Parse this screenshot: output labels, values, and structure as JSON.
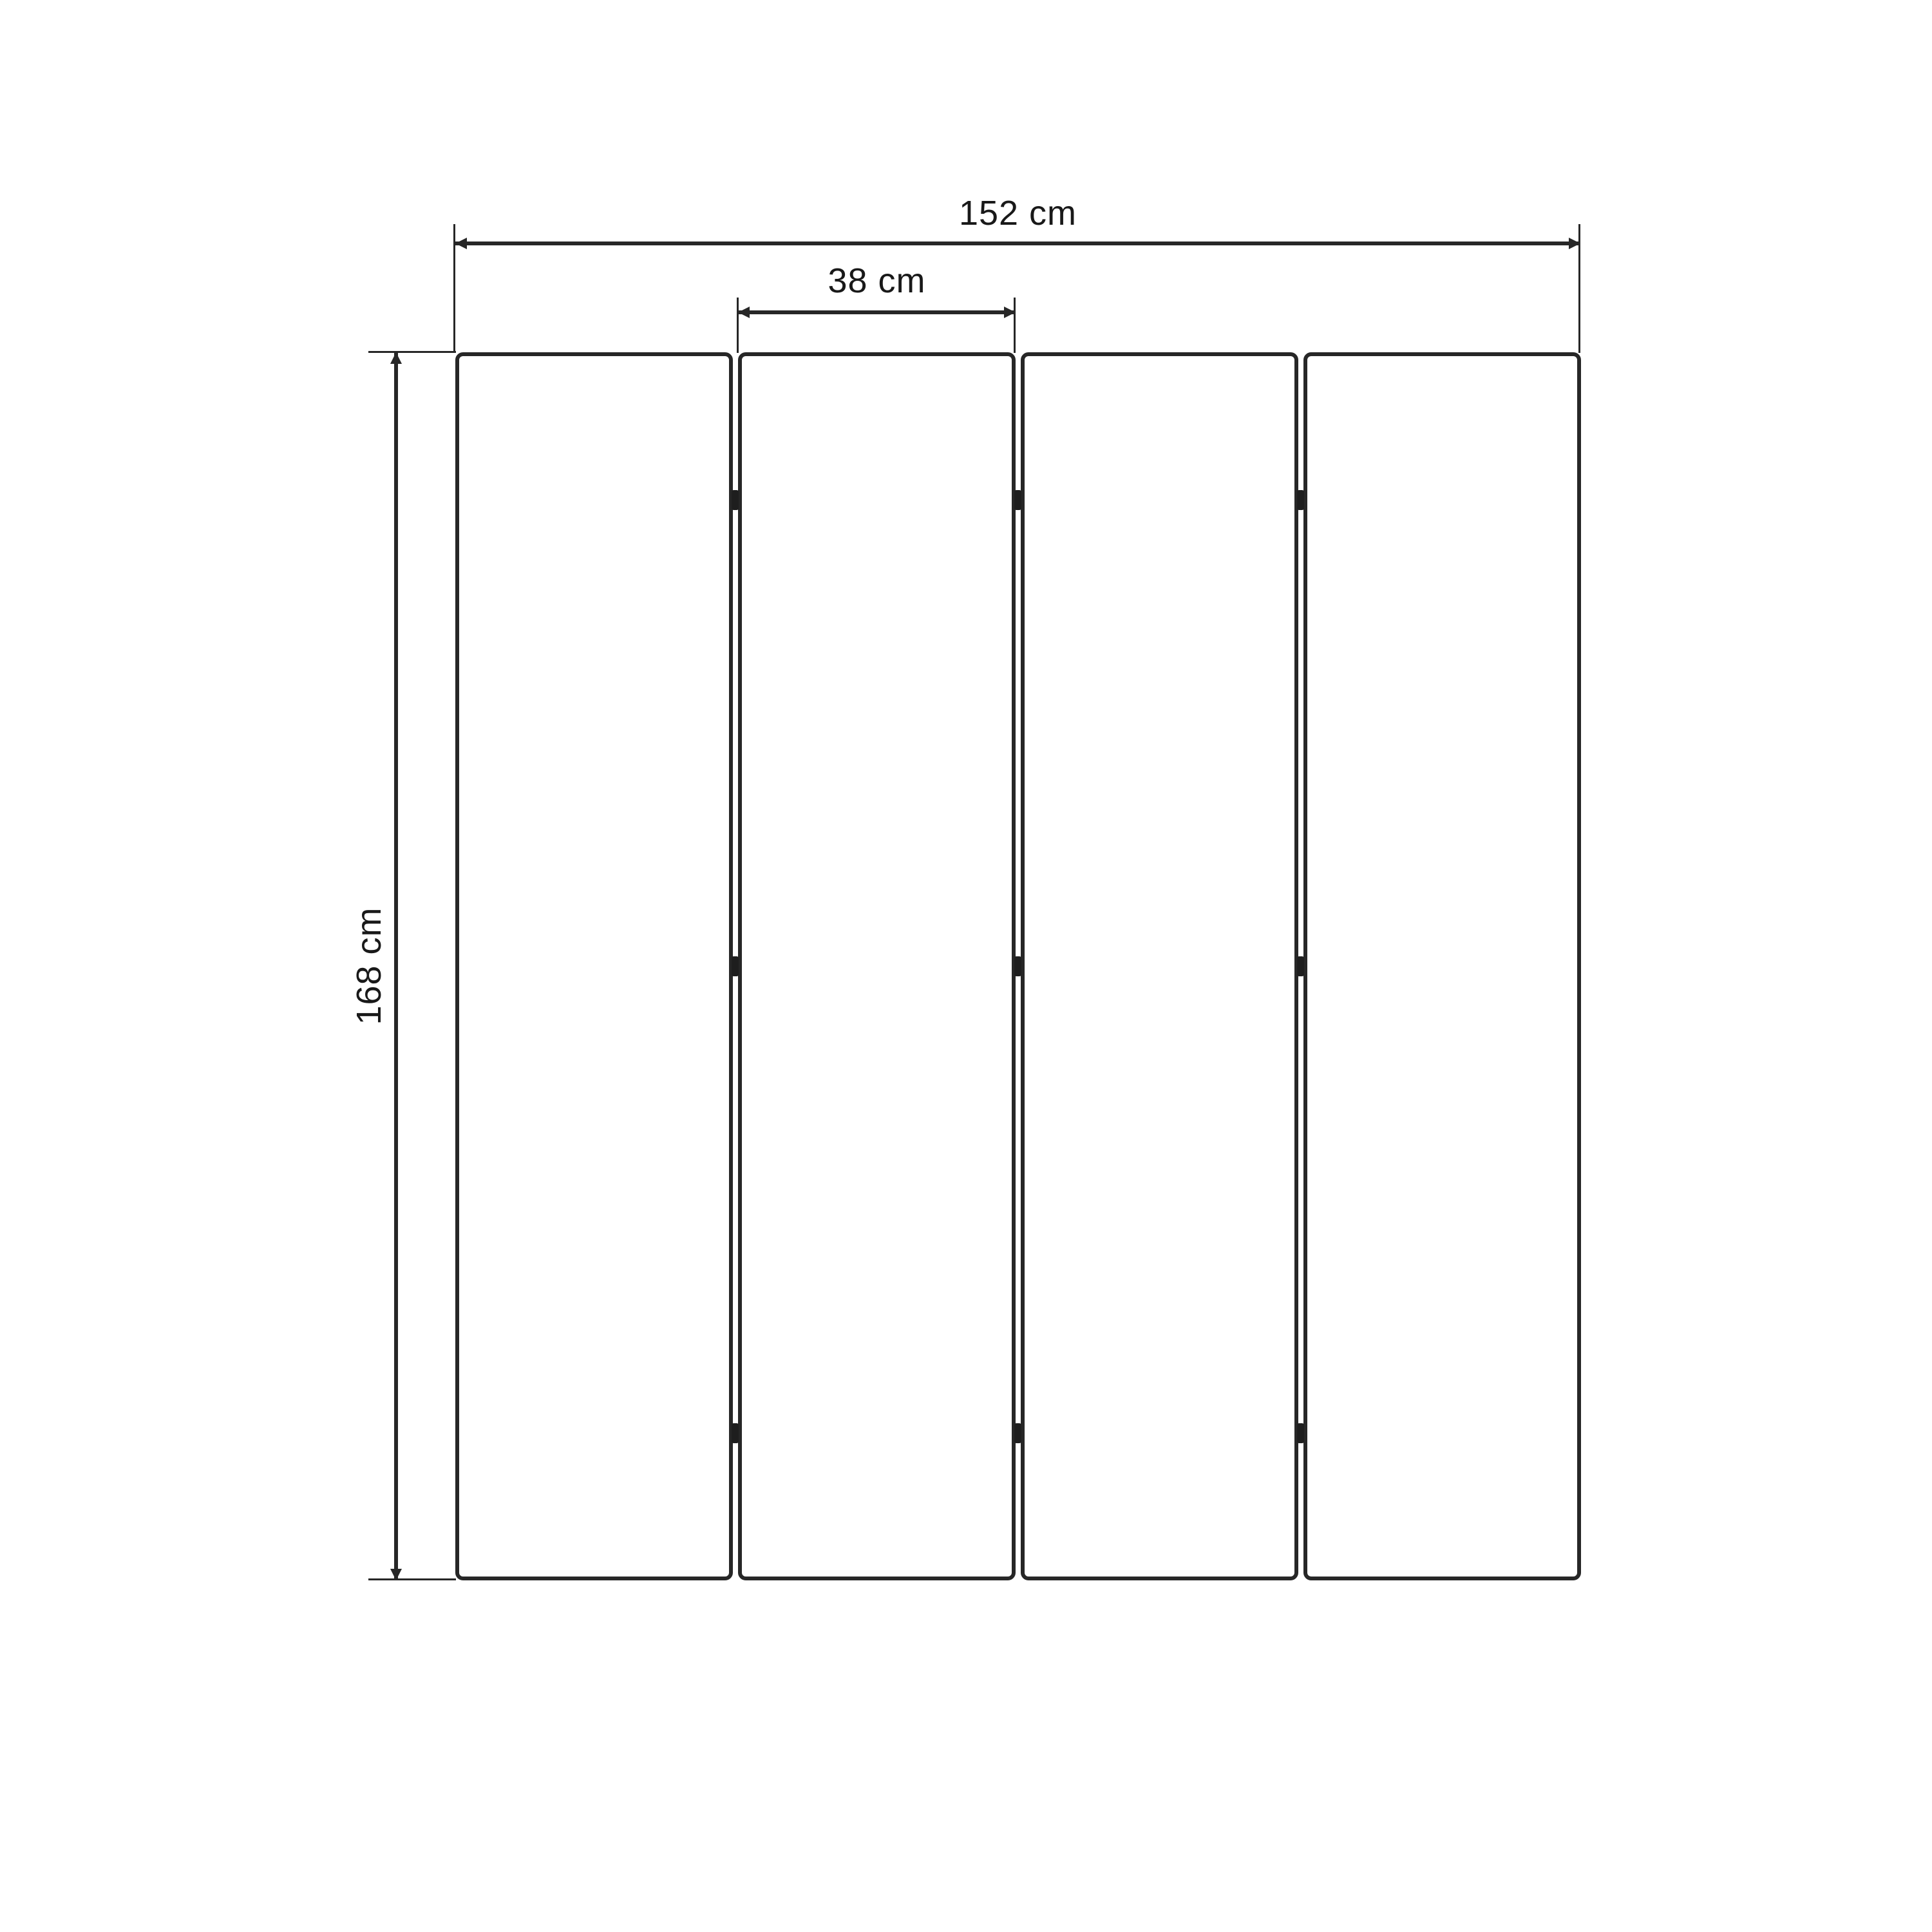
{
  "drawing": {
    "panel_count": 4,
    "hinge_count": 9
  },
  "labels": {
    "overall_width": "152 cm",
    "panel_width": "38 cm",
    "height": "168 cm"
  },
  "colors": {
    "background": "#ffffff",
    "line": "#272727",
    "hinge": "#1e1e1e",
    "text": "#191919"
  }
}
